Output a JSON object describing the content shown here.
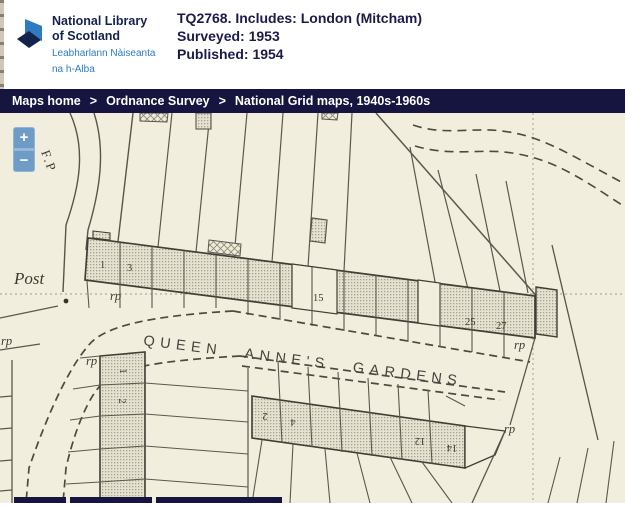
{
  "header": {
    "logo": {
      "name_line1": "National Library",
      "name_line2": "of Scotland",
      "gaelic_line1": "Leabharlann Nàiseanta",
      "gaelic_line2": "na h-Alba"
    },
    "title": "TQ2768. Includes: London (Mitcham)",
    "surveyed": "Surveyed: 1953",
    "published": "Published: 1954"
  },
  "breadcrumb": {
    "separator": ">",
    "items": [
      "Maps home",
      "Ordnance Survey",
      "National Grid maps, 1940s-1960s"
    ]
  },
  "zoom_controls": {
    "zoom_in": "+",
    "zoom_out": "−"
  },
  "map": {
    "street_name": "QUEEN ANNE'S GARDENS",
    "post_label": "Post",
    "footpath_label": "F.P",
    "rp": "rp",
    "house_numbers_top": [
      "1",
      "3",
      "15",
      "25",
      "27"
    ],
    "house_numbers_side": [
      "1",
      "2"
    ],
    "house_numbers_bottom": [
      "2",
      "4",
      "12",
      "14"
    ]
  },
  "colors": {
    "navy": "#15153f",
    "header_text": "#1b1b4a",
    "logo_blue": "#2e7bbf",
    "zoom_button": "#6f9cc7",
    "map_paper": "#f2eede",
    "map_ink": "#4c4a40"
  }
}
